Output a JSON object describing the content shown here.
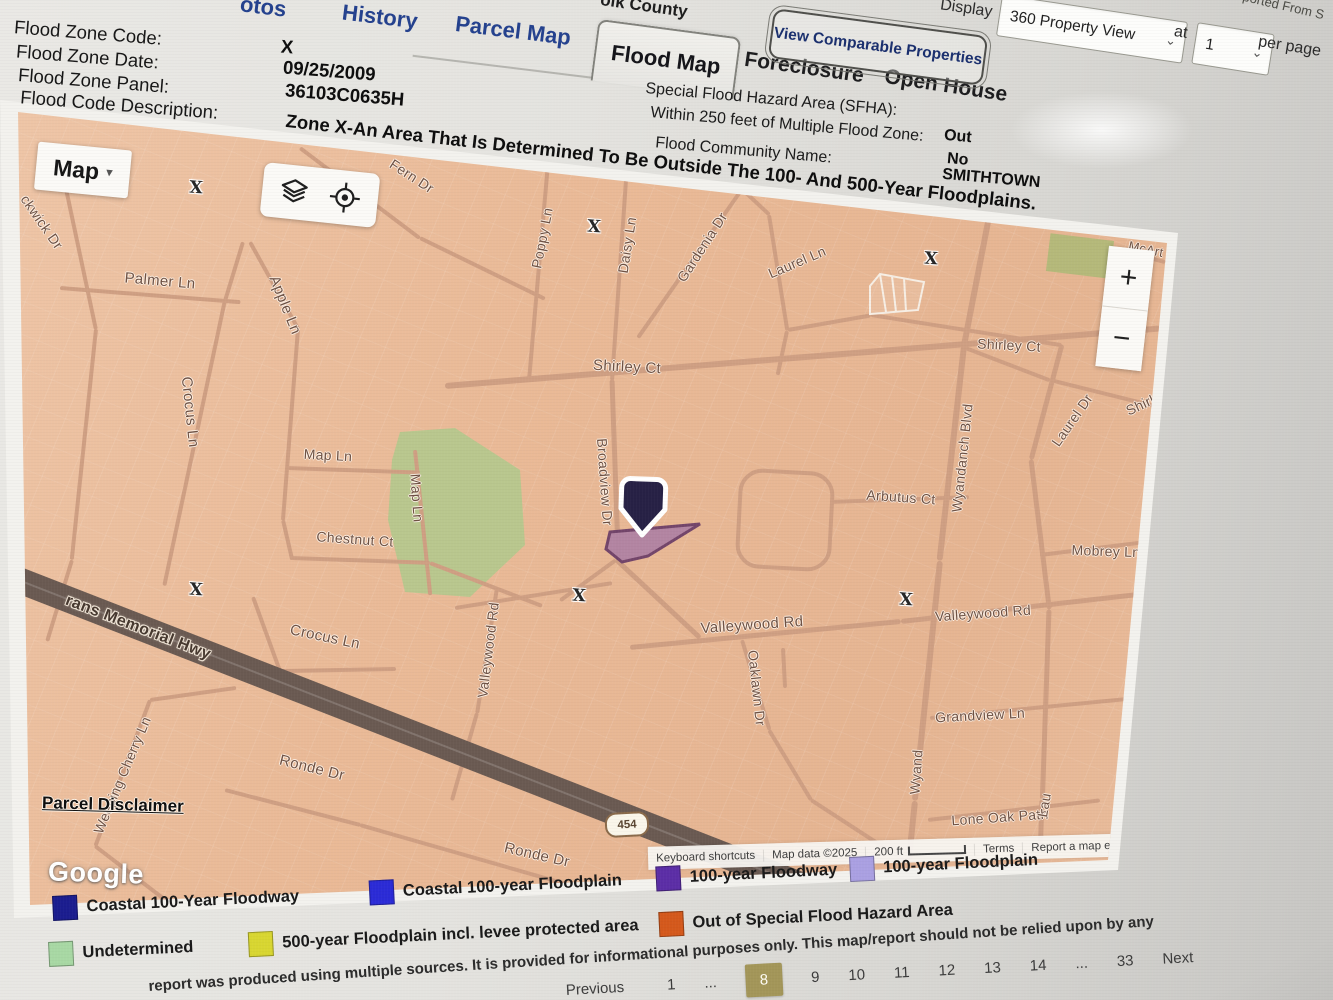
{
  "header": {
    "partial_tab": "otos",
    "tab_history": "History",
    "tab_parcel_map": "Parcel Map",
    "county_partial": "olk County",
    "tab_flood_map": "Flood Map",
    "tab_foreclosure": "Foreclosure",
    "tab_open_house": "Open House",
    "compare_button": "View Comparable Properties",
    "display_label": "Display",
    "display_value": "360 Property View",
    "at_label": "at",
    "page_size_value": "1",
    "per_page_label": "per page",
    "corner_partial": "ported From S"
  },
  "flood_info": {
    "rows": [
      {
        "label": "Flood Zone Code:",
        "value": "X"
      },
      {
        "label": "Flood Zone Date:",
        "value": "09/25/2009"
      },
      {
        "label": "Flood Zone Panel:",
        "value": "36103C0635H"
      },
      {
        "label": "Flood Code Description:",
        "value": "Zone X-An Area That Is Determined To Be Outside The 100- And 500-Year Floodplains."
      }
    ],
    "sfha": [
      {
        "label": "Special Flood Hazard Area (SFHA):",
        "value": "Out"
      },
      {
        "label": "Within 250 feet of Multiple Flood Zone:",
        "value": "No"
      },
      {
        "label": "Flood Community Name:",
        "value": "SMITHTOWN"
      }
    ]
  },
  "map": {
    "type_button": "Map",
    "x_marker": "X",
    "route_badge": "454",
    "hwy_label": "rans Memorial Hwy",
    "street_labels": [
      "Fern Dr",
      "ckwick Dr",
      "Palmer Ln",
      "Apple Ln",
      "Crocus Ln",
      "Map Ln",
      "Map Ln",
      "Chestnut Ct",
      "Shirley Ct",
      "Poppy Ln",
      "Daisy Ln",
      "Gardenia Dr",
      "Laurel Ln",
      "Broadview Dr",
      "Wyandanch Blvd",
      "Arbutus Ct",
      "Shirley Ct",
      "Laurel Dr",
      "Shirl",
      "McArt",
      "Mobrey Ln",
      "Valleywood Rd",
      "Valleywood Rd",
      "Valleywood Rd",
      "Oaklawn Dr",
      "Grandview Ln",
      "Lone Oak Path",
      "Crocus Ln",
      "Ronde Dr",
      "Ronde Dr",
      "Weeping Cherry Ln",
      "Wyand",
      "Lau"
    ],
    "zoom_in": "+",
    "zoom_out": "−",
    "parcel_disclaimer": "Parcel Disclaimer",
    "google_logo": "Google",
    "attribution": {
      "keyboard_shortcuts": "Keyboard shortcuts",
      "map_data": "Map data ©2025",
      "scale": "200 ft",
      "terms": "Terms",
      "report_error": "Report a map error"
    }
  },
  "legend": {
    "row1": [
      {
        "color": "#1b1d8f",
        "label": "Coastal 100-Year Floodway"
      },
      {
        "color": "#2b2bd6",
        "label": "Coastal 100-year Floodplain"
      },
      {
        "color": "#5c2ea6",
        "label": "100-year Floodway"
      },
      {
        "color": "#aaa0e2",
        "label": "100-year Floodplain"
      }
    ],
    "row2": [
      {
        "color": "#a8d8a4",
        "label": "Undetermined"
      },
      {
        "color": "#d8d631",
        "label": "500-year Floodplain incl. levee protected area"
      },
      {
        "color": "#d4591c",
        "label": "Out of Special Flood Hazard Area"
      }
    ]
  },
  "disclaimer": "report was produced using multiple sources. It is provided for informational purposes only. This map/report should not be relied upon by any",
  "pagination": {
    "items": [
      "Previous",
      "1",
      "...",
      "8",
      "9",
      "10",
      "11",
      "12",
      "13",
      "14",
      "...",
      "33",
      "Next"
    ],
    "active": "8"
  },
  "icons": {
    "caret_down": "▾",
    "chevron_down": "⌄"
  }
}
